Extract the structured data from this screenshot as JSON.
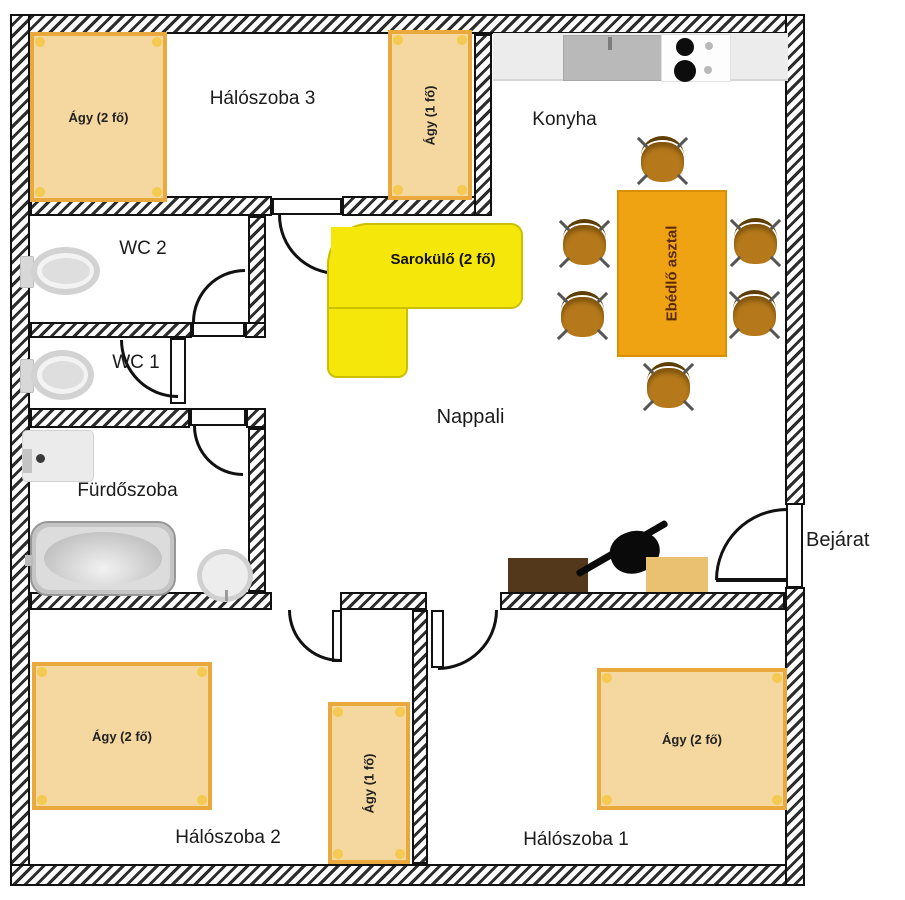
{
  "rooms": {
    "bedroom3": {
      "label": "Hálószoba 3"
    },
    "kitchen": {
      "label": "Konyha",
      "chair_count": 6
    },
    "wc2": {
      "label": "WC 2"
    },
    "wc1": {
      "label": "WC 1"
    },
    "bathroom": {
      "label": "Fürdőszoba"
    },
    "living_room": {
      "label": "Nappali"
    },
    "entrance": {
      "label": "Bejárat"
    },
    "bedroom2": {
      "label": "Hálószoba 2"
    },
    "bedroom1": {
      "label": "Hálószoba 1"
    }
  },
  "furniture": {
    "bedroom3_double_bed": {
      "label": "Ágy (2 fő)"
    },
    "bedroom3_single_bed": {
      "label": "Ágy (1 fő)"
    },
    "corner_sofa": {
      "label": "Sarokülő (2 fő)"
    },
    "dining_table": {
      "label": "Ebédlő asztal"
    },
    "bedroom2_double_bed": {
      "label": "Ágy (2 fő)"
    },
    "bedroom2_single_bed": {
      "label": "Ágy (1 fő)"
    },
    "bedroom1_double_bed": {
      "label": "Ágy (2 fő)"
    }
  },
  "colors": {
    "bed_fill": "#f5d7a0",
    "bed_border": "#eaa93c",
    "table": "#f0a312",
    "chair": "#b5791b",
    "sofa": "#f6e70a",
    "tv_stand": "#53381c",
    "cabinet": "#e9c170",
    "wall_line": "#111111"
  }
}
